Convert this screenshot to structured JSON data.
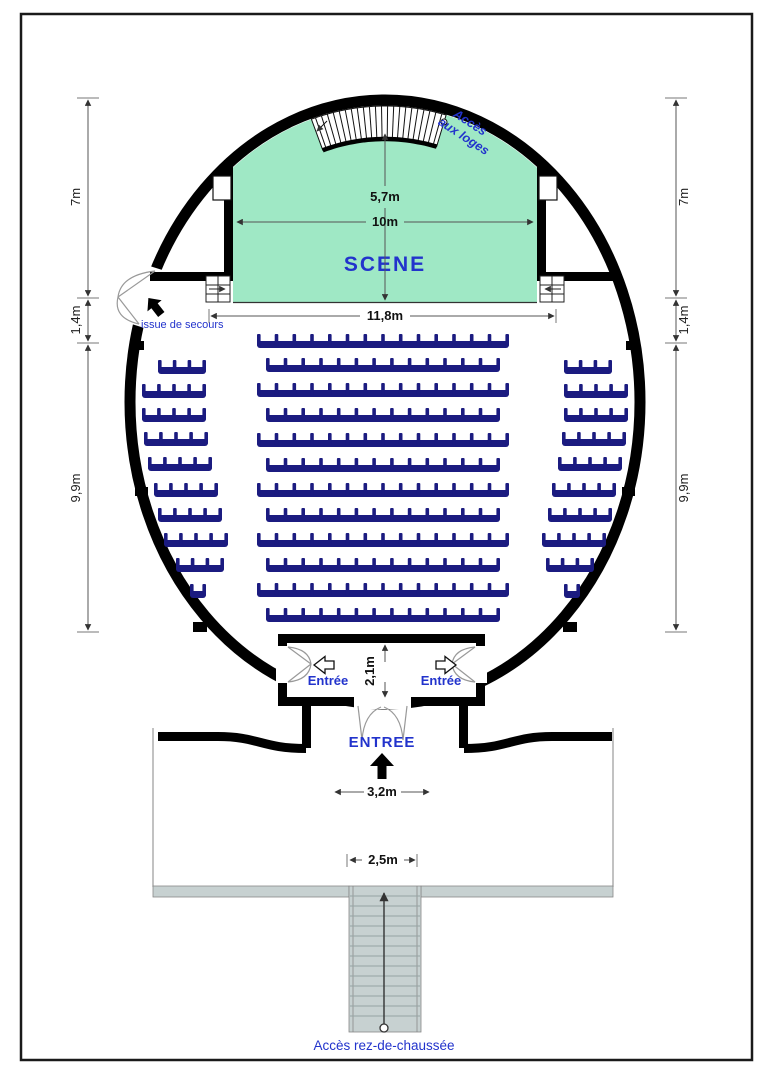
{
  "plan_title": "Salle de spectacle - plan du rez-de-chaussee",
  "colors": {
    "stage_green": "#9fe8c5",
    "seat_navy": "#1b1b80",
    "label_blue": "#2233cc",
    "wall_black": "#000000",
    "stair_gray": "#c7d1d1",
    "dim_gray": "#555555"
  },
  "labels": {
    "acces_loges_line1": "Accès",
    "acces_loges_line2": "aux loges",
    "scene": "SCENE",
    "issue_secours": "issue de secours",
    "entree_left": "Entrée",
    "entree_right": "Entrée",
    "entree_main": "ENTREE",
    "acces_rdc": "Accès rez-de-chaussée"
  },
  "dims": {
    "stage_depth": "5,7m",
    "stage_width": "10m",
    "stage_opening": "11,8m",
    "left_7m": "7m",
    "left_1_4m": "1,4m",
    "left_9_9m": "9,9m",
    "right_7m": "7m",
    "right_1_4m": "1,4m",
    "right_9_9m": "9,9m",
    "vestibule_depth": "2,1m",
    "entrance_width": "3,2m",
    "stair_width": "2,5m"
  },
  "seating": {
    "center_rows": [
      {
        "x": 257,
        "y": 334,
        "w": 252,
        "n": 14
      },
      {
        "x": 266,
        "y": 358,
        "w": 234,
        "n": 13
      },
      {
        "x": 257,
        "y": 383,
        "w": 252,
        "n": 14
      },
      {
        "x": 266,
        "y": 408,
        "w": 234,
        "n": 13
      },
      {
        "x": 257,
        "y": 433,
        "w": 252,
        "n": 14
      },
      {
        "x": 266,
        "y": 458,
        "w": 234,
        "n": 13
      },
      {
        "x": 257,
        "y": 483,
        "w": 252,
        "n": 14
      },
      {
        "x": 266,
        "y": 508,
        "w": 234,
        "n": 13
      },
      {
        "x": 257,
        "y": 533,
        "w": 252,
        "n": 14
      },
      {
        "x": 266,
        "y": 558,
        "w": 234,
        "n": 13
      },
      {
        "x": 257,
        "y": 583,
        "w": 252,
        "n": 14
      },
      {
        "x": 266,
        "y": 608,
        "w": 234,
        "n": 13
      }
    ],
    "left_rows": [
      {
        "x": 158,
        "y": 360,
        "w": 48,
        "n": 3
      },
      {
        "x": 142,
        "y": 384,
        "w": 64,
        "n": 4
      },
      {
        "x": 142,
        "y": 408,
        "w": 64,
        "n": 4
      },
      {
        "x": 144,
        "y": 432,
        "w": 64,
        "n": 4
      },
      {
        "x": 148,
        "y": 457,
        "w": 64,
        "n": 4
      },
      {
        "x": 154,
        "y": 483,
        "w": 64,
        "n": 4
      },
      {
        "x": 158,
        "y": 508,
        "w": 64,
        "n": 4
      },
      {
        "x": 164,
        "y": 533,
        "w": 64,
        "n": 4
      },
      {
        "x": 176,
        "y": 558,
        "w": 48,
        "n": 3
      },
      {
        "x": 190,
        "y": 584,
        "w": 16,
        "n": 1
      }
    ],
    "right_rows": [
      {
        "x": 564,
        "y": 360,
        "w": 48,
        "n": 3
      },
      {
        "x": 564,
        "y": 384,
        "w": 64,
        "n": 4
      },
      {
        "x": 564,
        "y": 408,
        "w": 64,
        "n": 4
      },
      {
        "x": 562,
        "y": 432,
        "w": 64,
        "n": 4
      },
      {
        "x": 558,
        "y": 457,
        "w": 64,
        "n": 4
      },
      {
        "x": 552,
        "y": 483,
        "w": 64,
        "n": 4
      },
      {
        "x": 548,
        "y": 508,
        "w": 64,
        "n": 4
      },
      {
        "x": 542,
        "y": 533,
        "w": 64,
        "n": 4
      },
      {
        "x": 546,
        "y": 558,
        "w": 48,
        "n": 3
      },
      {
        "x": 564,
        "y": 584,
        "w": 16,
        "n": 1
      }
    ]
  },
  "loges_band": {
    "hatch_count": 21
  },
  "main_stairs": {
    "tread_count": 13
  }
}
